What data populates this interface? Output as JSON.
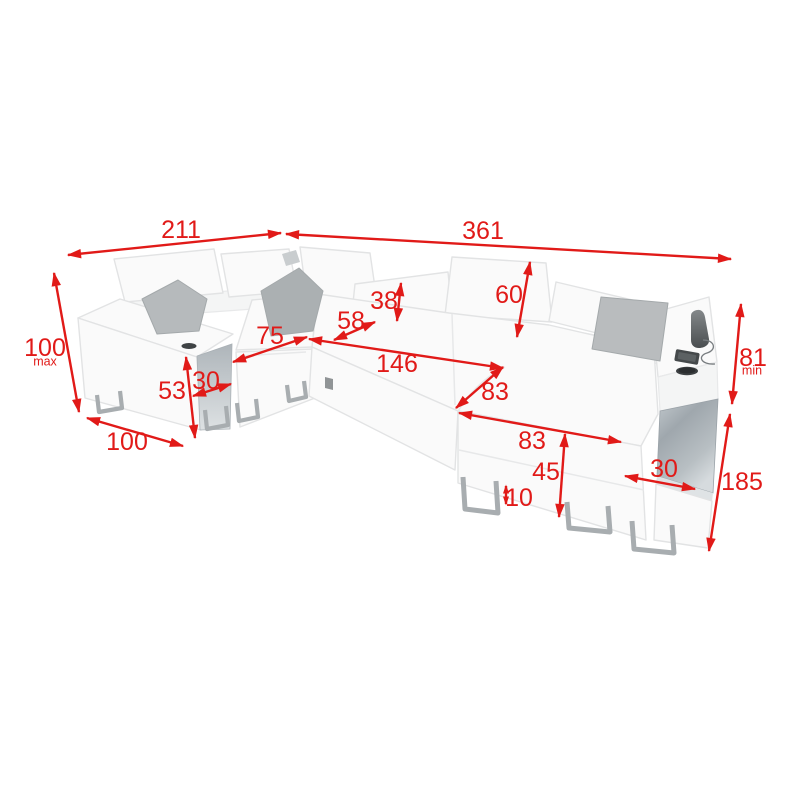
{
  "page": {
    "background": "#ffffff"
  },
  "colors": {
    "dimension_red": "#e11a18",
    "sofa_fill": "#fafafa",
    "sofa_stroke": "#e2e3e4",
    "panel_gray_left": "#b3bac0",
    "panel_gray_right": "#9fa7ad",
    "pillow_gray": "#b6babc",
    "leg_gray": "#a8adb0",
    "accessory_dark": "#3f4345"
  },
  "diagram": {
    "subject": "u-shaped-corner-sofa-dimension-diagram",
    "unit_note_max": "max",
    "unit_note_min": "min",
    "dimensions": [
      {
        "id": "back-width-left",
        "value": "211",
        "line": [
          68,
          255,
          281,
          233
        ],
        "label": [
          181,
          229
        ]
      },
      {
        "id": "back-width-right",
        "value": "361",
        "line": [
          286,
          234,
          731,
          259
        ],
        "label": [
          483,
          230
        ]
      },
      {
        "id": "backrest-height-max",
        "value": "100",
        "sub": "max",
        "line": [
          54,
          273,
          79,
          412
        ],
        "label": [
          45,
          347
        ],
        "sub_label": [
          45,
          361
        ]
      },
      {
        "id": "left-side-depth",
        "value": "100",
        "line": [
          87,
          418,
          183,
          446
        ],
        "label": [
          127,
          441
        ]
      },
      {
        "id": "armrest-height",
        "value": "53",
        "line": [
          186,
          357,
          195,
          438
        ],
        "label": [
          172,
          390
        ]
      },
      {
        "id": "armrest-width-left",
        "value": "30",
        "line": [
          193,
          396,
          231,
          384
        ],
        "label": [
          206,
          380
        ]
      },
      {
        "id": "seat-width-left",
        "value": "75",
        "line": [
          233,
          362,
          307,
          337
        ],
        "label": [
          270,
          335
        ]
      },
      {
        "id": "seat-depth",
        "value": "58",
        "line": [
          334,
          340,
          375,
          322
        ],
        "label": [
          351,
          320
        ]
      },
      {
        "id": "headrest-height-folded",
        "value": "38",
        "line": [
          401,
          283,
          397,
          321
        ],
        "label": [
          384,
          300
        ]
      },
      {
        "id": "bed-width",
        "value": "146",
        "line": [
          309,
          339,
          503,
          368
        ],
        "label": [
          397,
          363
        ]
      },
      {
        "id": "backrest-height-raised",
        "value": "60",
        "line": [
          530,
          262,
          517,
          337
        ],
        "label": [
          509,
          294
        ]
      },
      {
        "id": "chaise-depth",
        "value": "83",
        "line": [
          456,
          408,
          503,
          367
        ],
        "label": [
          495,
          391
        ]
      },
      {
        "id": "chaise-width",
        "value": "83",
        "line": [
          459,
          413,
          621,
          442
        ],
        "label": [
          532,
          440
        ]
      },
      {
        "id": "seat-height",
        "value": "45",
        "line": [
          565,
          434,
          559,
          517
        ],
        "label": [
          546,
          471
        ]
      },
      {
        "id": "leg-height",
        "value": "10",
        "line": [
          506,
          486,
          506,
          504
        ],
        "label": [
          519,
          497
        ]
      },
      {
        "id": "armrest-width-right",
        "value": "30",
        "line": [
          625,
          476,
          695,
          489
        ],
        "label": [
          664,
          468
        ]
      },
      {
        "id": "armrest-height-min",
        "value": "81",
        "sub": "min",
        "line": [
          741,
          304,
          732,
          404
        ],
        "label": [
          753,
          357
        ],
        "sub_label": [
          752,
          370
        ]
      },
      {
        "id": "total-depth-right",
        "value": "185",
        "line": [
          730,
          414,
          709,
          551
        ],
        "label": [
          742,
          481
        ]
      }
    ]
  }
}
